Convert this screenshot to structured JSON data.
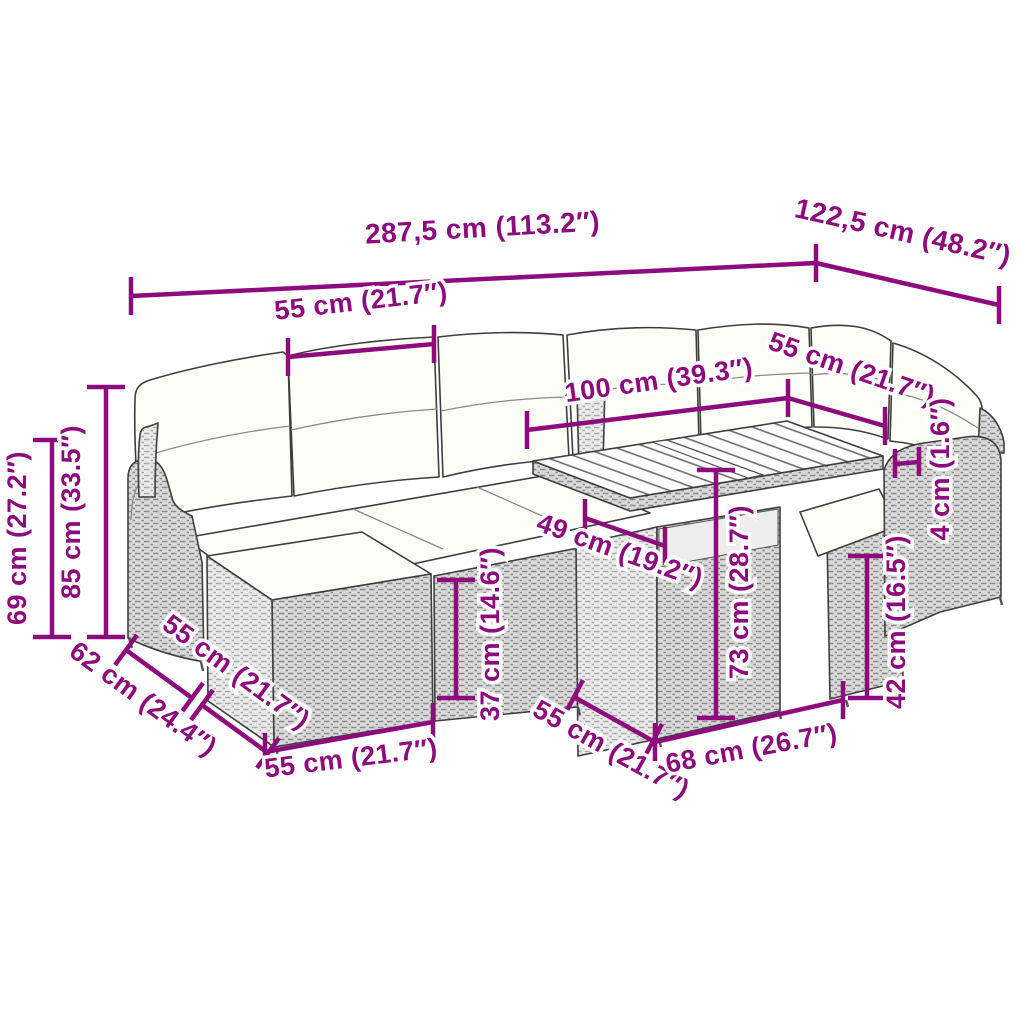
{
  "page": {
    "title": "Garden furniture set dimension diagram",
    "description": "Line drawing of a poly rattan corner sofa set with cushions, ottoman and slatted acacia-wood top table, annotated with measurements"
  },
  "colors": {
    "dimension": "#8e0b7d",
    "line_art": "#3e3e3e",
    "cushion": "#fdfdf8"
  },
  "dimensions": {
    "total_width": "287,5 cm (113.2″)",
    "total_depth": "122,5 cm (48.2″)",
    "seat_width_back_left": "55 cm (21.7″)",
    "table_top_length": "100 cm (39.3″)",
    "seat_width_back_right": "55 cm (21.7″)",
    "table_top_thickness": "4 cm (1.6″)",
    "arm_height": "69 cm (27.2″)",
    "back_height": "85 cm (33.5″)",
    "ottoman_footprint_depth": "62 cm (24.4″)",
    "ottoman_top_width": "55 cm (21.7″)",
    "ottoman_front_width": "55 cm (21.7″)",
    "seat_height": "37 cm (14.6″)",
    "table_shelf_width": "49 cm (19.2″)",
    "seat_depth_mid": "55 cm (21.7″)",
    "table_base_width": "68 cm (26.7″)",
    "table_height": "73 cm (28.7″)",
    "table_base_height": "42 cm (16.5″)"
  }
}
